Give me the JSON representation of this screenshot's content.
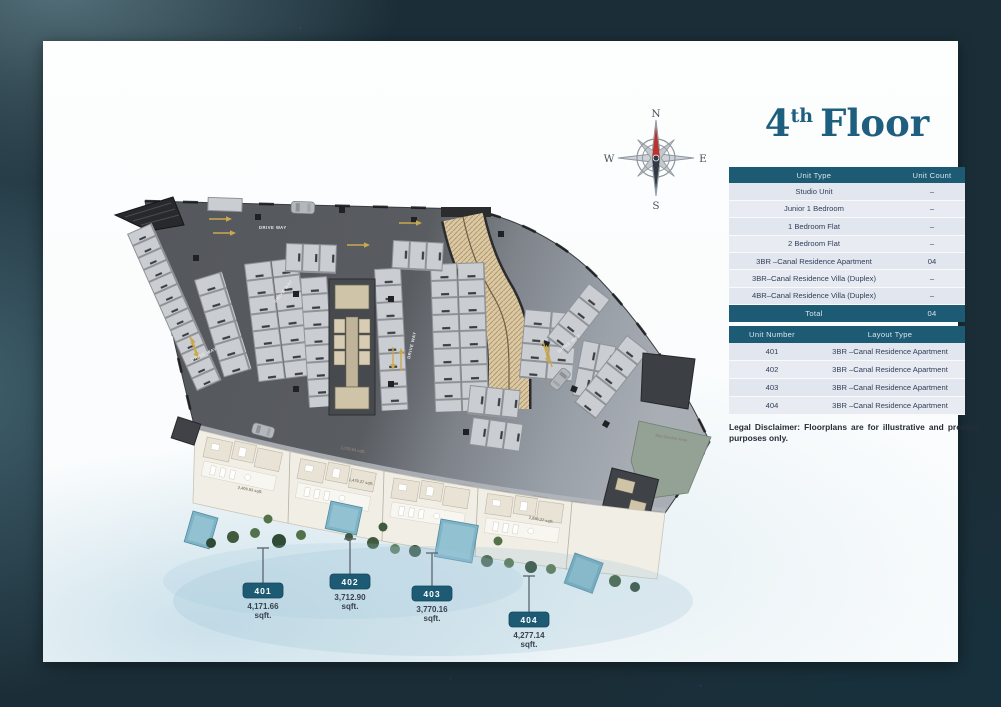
{
  "header": {
    "title_number": "4",
    "title_ordinal": "th",
    "title_text": "Floor"
  },
  "compass": {
    "north": "N",
    "east": "E",
    "south": "S",
    "west": "W"
  },
  "unit_type_table": {
    "col1": "Unit Type",
    "col2": "Unit Count",
    "rows": [
      {
        "type": "Studio Unit",
        "count": "–"
      },
      {
        "type": "Junior 1 Bedroom",
        "count": "–"
      },
      {
        "type": "1 Bedroom Flat",
        "count": "–"
      },
      {
        "type": "2 Bedroom Flat",
        "count": "–"
      },
      {
        "type": "3BR –Canal Residence Apartment",
        "count": "04"
      },
      {
        "type": "3BR–Canal Residence Villa (Duplex)",
        "count": "–"
      },
      {
        "type": "4BR–Canal Residence Villa (Duplex)",
        "count": "–"
      }
    ],
    "total_label": "Total",
    "total_count": "04"
  },
  "unit_number_table": {
    "col1": "Unit Number",
    "col2": "Layout Type",
    "rows": [
      {
        "unit": "401",
        "layout": "3BR –Canal Residence Apartment"
      },
      {
        "unit": "402",
        "layout": "3BR –Canal Residence Apartment"
      },
      {
        "unit": "403",
        "layout": "3BR –Canal Residence Apartment"
      },
      {
        "unit": "404",
        "layout": "3BR –Canal Residence Apartment"
      }
    ]
  },
  "disclaimer": {
    "label": "Legal Disclaimer:",
    "text": "Floorplans are for illustrative and preview purposes only."
  },
  "callouts": [
    {
      "unit": "401",
      "area": "4,171.66",
      "suffix": "sqft."
    },
    {
      "unit": "402",
      "area": "3,712.90",
      "suffix": "sqft."
    },
    {
      "unit": "403",
      "area": "3,770.16",
      "suffix": "sqft."
    },
    {
      "unit": "404",
      "area": "4,277.14",
      "suffix": "sqft."
    }
  ],
  "plan": {
    "driveway_label": "DRIVE WAY",
    "interior_area_labels": [
      "2,409.83 sqft.",
      "1,723.53 sqft.",
      "1,479.27 sqft.",
      "2,856.27 sqft."
    ],
    "sky_garden_label": "Sky Garden Area",
    "colors": {
      "accent_teal": "#1d5a73",
      "title_teal": "#1e5e7e",
      "north_red": "#b8342c",
      "slab_dark": "#55585d",
      "slab_light": "#9ba0a8",
      "ramp_tan": "#dcc8a2",
      "pool_blue": "#7fb3c6"
    }
  }
}
